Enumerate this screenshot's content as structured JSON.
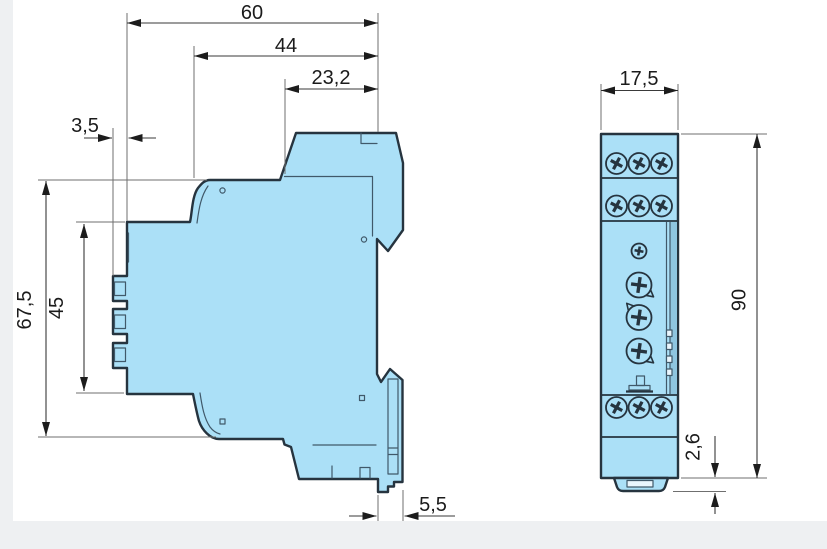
{
  "drawing_title": "DIN-rail module dimension drawing",
  "colors": {
    "body_fill": "#abe0f7",
    "outline": "#26343f",
    "panel_strip": "#8fc6e0",
    "slot_fill": "#eaf6fd",
    "dimension_line": "#3a3a3a",
    "page_band": "#eef0f2"
  },
  "side_view": {
    "dimensions": {
      "depth_total": "60",
      "depth_body": "44",
      "depth_front_block": "23,2",
      "terminal_protrusion": "3,5",
      "height_body": "67,5",
      "height_terminal_section": "45",
      "rail_clip_depth": "5,5"
    }
  },
  "front_view": {
    "dimensions": {
      "width": "17,5",
      "height": "90",
      "bottom_tab_height": "2,6"
    }
  }
}
